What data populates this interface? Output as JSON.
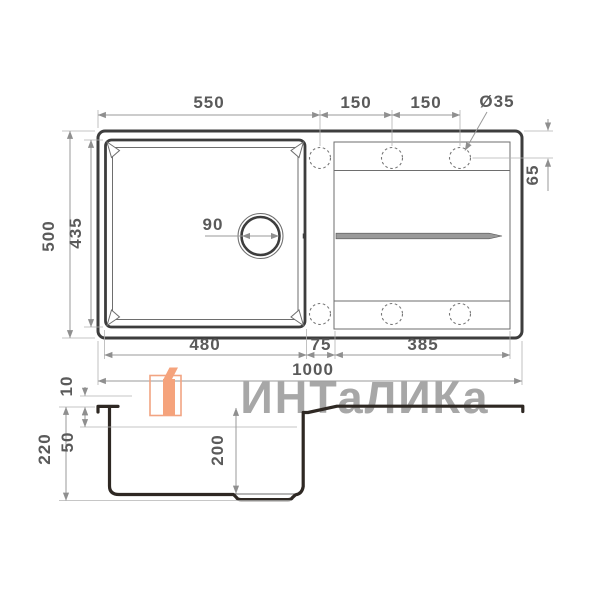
{
  "colors": {
    "background": "#ffffff",
    "profile_line": "#2e2823",
    "drawing_line": "#3d3d3d",
    "thin_line": "#6e6e6e",
    "dim_line": "#9a9a9a",
    "dim_text": "#5a5a5a",
    "watermark_gray": "#a7a7a7",
    "logo_orange": "#f5a37c",
    "logo_orange_outline": "#f2a482"
  },
  "watermark": {
    "text": "ИНТаЛИКа"
  },
  "top_view": {
    "dim_top_width": "550",
    "dim_hole_pitch_1": "150",
    "dim_hole_pitch_2": "150",
    "dim_hole_diameter": "Ø35",
    "dim_overall_depth": "500",
    "dim_bowl_depth_outer": "435",
    "dim_hole_edge_offset": "65",
    "dim_drain_diameter": "90",
    "dim_bowl_width": "480",
    "dim_divider_width": "75",
    "dim_drainboard_width": "385",
    "dim_overall_width": "1000"
  },
  "side_view": {
    "dim_rim_height": "10",
    "dim_total_height": "220",
    "dim_ledge_depth": "50",
    "dim_bowl_depth": "200"
  }
}
